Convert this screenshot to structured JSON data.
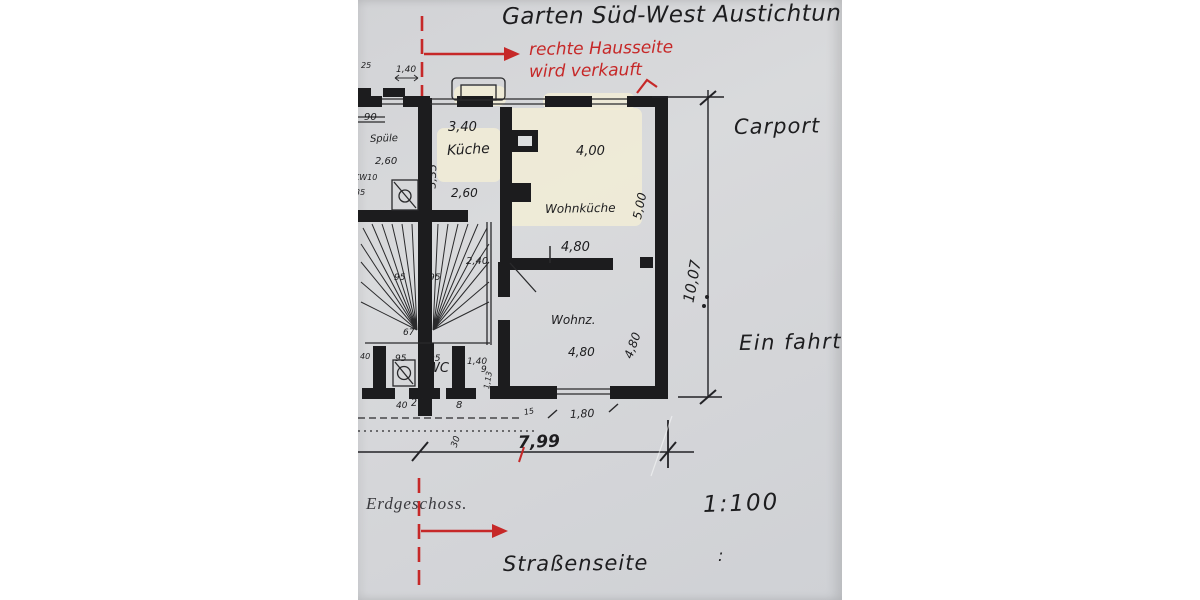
{
  "annotations": {
    "title": "Garten Süd-West Austichtung",
    "red_note_line1": "rechte Hausseite",
    "red_note_line2": "wird verkauft",
    "carport": "Carport",
    "driveway": "Ein fahrt",
    "scale": "1:100",
    "colon": ":",
    "street_side": "Straßenseite",
    "floor_label": "Erdgeschoss."
  },
  "rooms": {
    "kitchen": "Küche",
    "living_kitchen": "Wohnküche",
    "living_room": "Wohnz.",
    "wc": "WC",
    "sink": "Spüle",
    "appliance": "KW10"
  },
  "dims": {
    "w340": "3,40",
    "h335": "3,35",
    "w260": "2,60",
    "w260b": "2,60",
    "w400": "4,00",
    "h500": "5,00",
    "w480": "4,80",
    "w480b": "4,80",
    "h480": "4,80",
    "w240": "2,40",
    "s95a": "95",
    "s95b": "95",
    "s95c": "95",
    "s95d": "95",
    "s67": "67",
    "w140": "1,40",
    "w140b": "1,40",
    "s90": "90",
    "s25": "25",
    "s35": "35",
    "s40a": "40",
    "s40b": "40",
    "s27": "27",
    "s8": "8",
    "s30": "30",
    "s15": "15",
    "s5a": "5",
    "s5b": "5",
    "s9": "9",
    "s113": "1,13",
    "w180": "1,80",
    "total_width": "7,99",
    "total_depth": "10,07"
  },
  "colors": {
    "ink": "#1d1d1f",
    "red": "#c62828",
    "paper": "#d6d7d9",
    "highlight": "#f3eed6"
  }
}
